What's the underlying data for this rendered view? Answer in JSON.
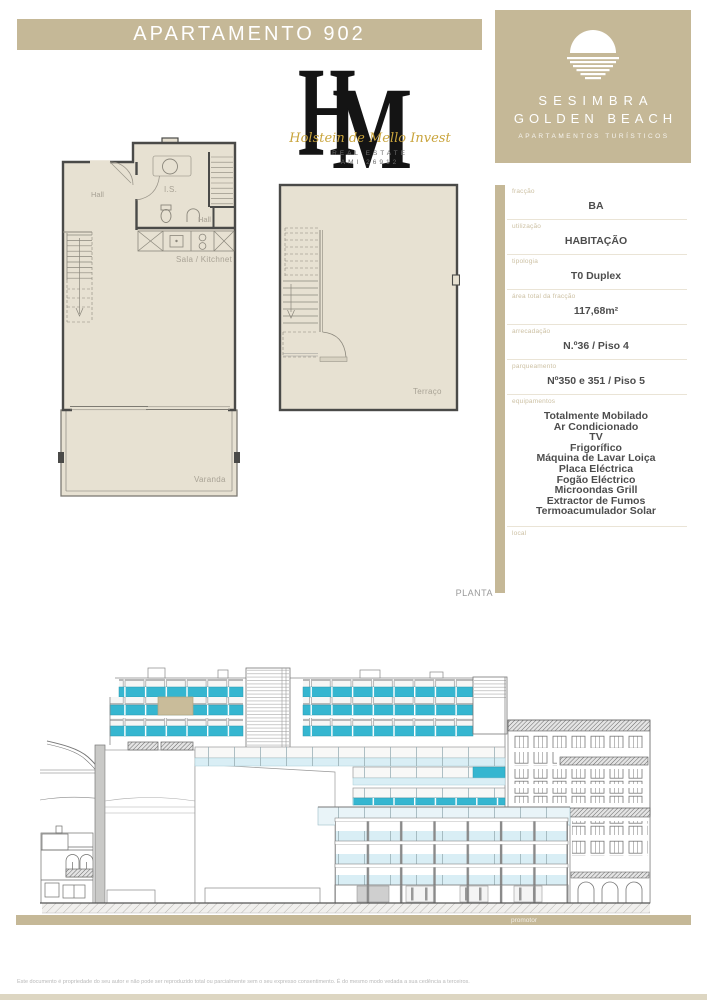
{
  "page": {
    "title": "APARTAMENTO 902",
    "section_label": "PLANTA",
    "promoter_label": "promotor",
    "footer_disclaimer": "Este documento é propriedade do seu autor e não pode ser reproduzido total ou parcialmente sem o seu expresso consentimento. É do mesmo modo vedada a sua cedência a terceiros."
  },
  "hm_logo": {
    "monogram_h": "H",
    "monogram_m": "M",
    "script_name": "Holstein de Mello Invest",
    "subline1": "REAL ESTATE",
    "subline2": "AMI 26912"
  },
  "resort_logo": {
    "name_line1": "SESIMBRA",
    "name_line2": "GOLDEN BEACH",
    "tagline": "APARTAMENTOS TURÍSTICOS"
  },
  "details_panel": {
    "fields": [
      {
        "label": "fracção",
        "value": "BA"
      },
      {
        "label": "utilização",
        "value": "HABITAÇÃO"
      },
      {
        "label": "tipologia",
        "value": "T0 Duplex"
      },
      {
        "label": "área total da fracção",
        "value": "117,68m²"
      },
      {
        "label": "arrecadação",
        "value": "N.º36 / Piso 4"
      },
      {
        "label": "parqueamento",
        "value": "Nº350 e 351 / Piso 5"
      },
      {
        "label": "equipamentos",
        "lines": [
          "Totalmente Mobilado",
          "Ar Condicionado",
          "TV",
          "Frigorífico",
          "Máquina de Lavar Loiça",
          "Placa Eléctrica",
          "Fogão Eléctrico",
          "Microondas Grill",
          "Extractor de Fumos",
          "Termoacumulador Solar"
        ]
      },
      {
        "label": "local",
        "value": ""
      }
    ]
  },
  "plans": {
    "lower": {
      "hall": "Hall",
      "bathroom": "I.S.",
      "hall_small": "Hall",
      "living": "Sala / Kitchnet",
      "balcony": "Varanda"
    },
    "upper": {
      "terrace": "Terraço"
    }
  },
  "colors": {
    "accent_tan": "#c5b897",
    "marker_tan": "#c9bc9a",
    "teal_glass": "#35b6d0",
    "light_glass": "#d9eef5",
    "plan_fill": "#e7e1d2"
  }
}
